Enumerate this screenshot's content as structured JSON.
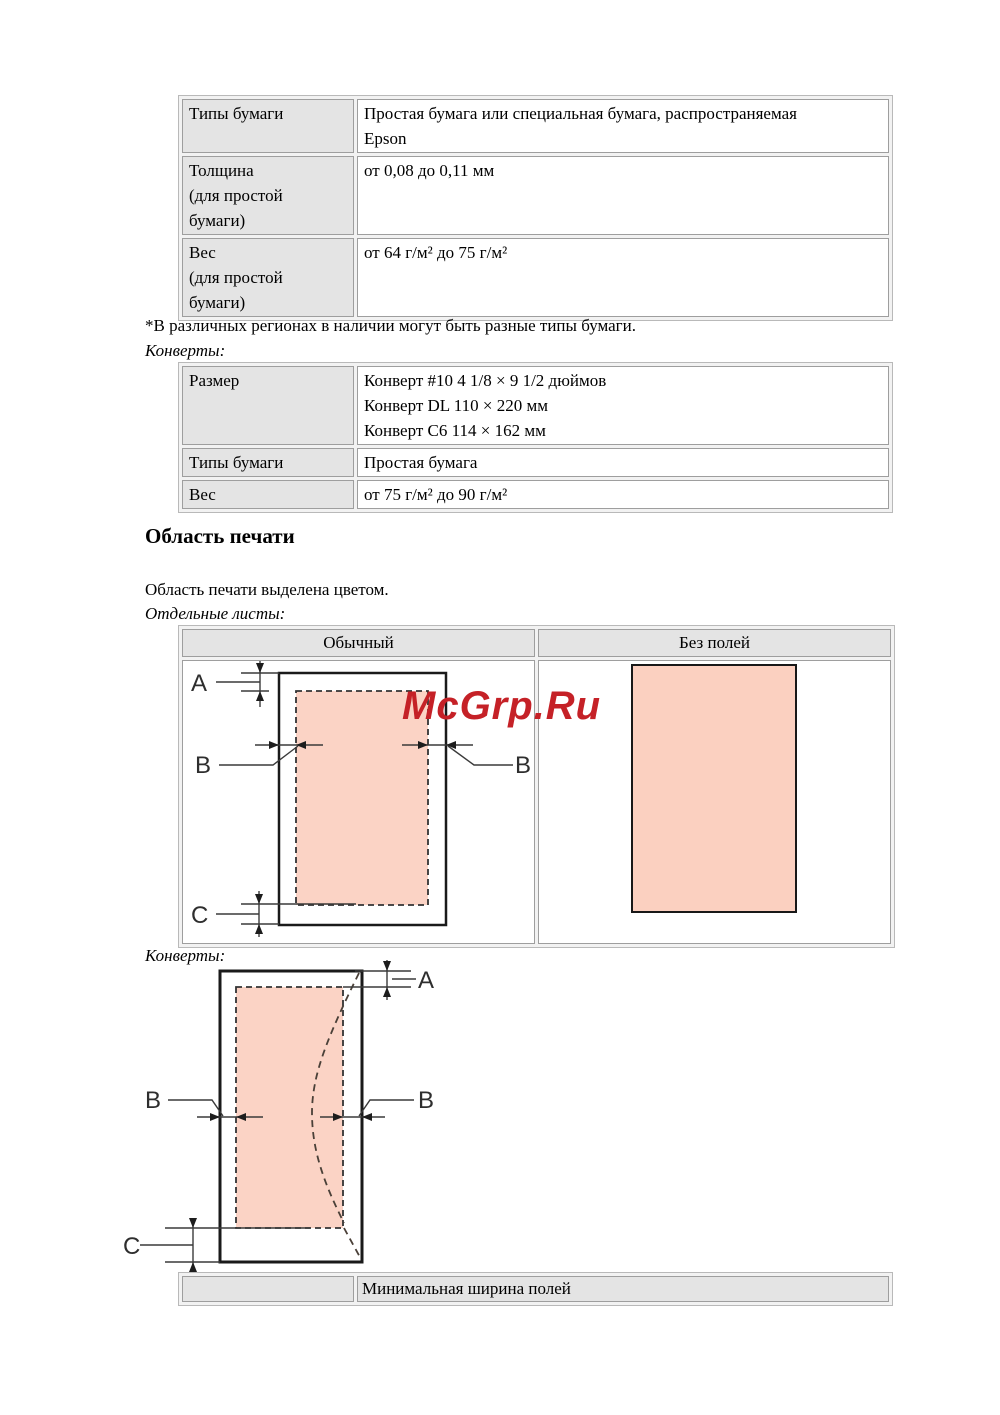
{
  "colors": {
    "print_area_fill": "#fbd3c5",
    "borderless_fill": "#fbd0c0",
    "watermark_red": "#c52127",
    "header_cell_gray": "#e4e4e4",
    "table_border_gray": "#9e9e9e"
  },
  "paper_table": {
    "rows": [
      {
        "label_lines": [
          "Типы бумаги"
        ],
        "value_lines": [
          "Простая бумага или специальная бумага, распространяемая",
          "Epson"
        ]
      },
      {
        "label_lines": [
          "Толщина",
          "(для простой",
          "бумаги)"
        ],
        "value_lines": [
          "от 0,08 до 0,11 мм"
        ]
      },
      {
        "label_lines": [
          "Вес",
          "(для простой",
          "бумаги)"
        ],
        "value_lines": [
          "от 64 г/м² до 75 г/м²"
        ]
      }
    ]
  },
  "footnote": "*В различных регионах в наличии могут быть разные типы бумаги.",
  "envelopes_label_1": "Конверты:",
  "envelope_table": {
    "rows": [
      {
        "label_lines": [
          "Размер"
        ],
        "value_lines": [
          "Конверт #10 4 1/8 × 9 1/2 дюймов",
          "Конверт DL 110 × 220 мм",
          "Конверт C6 114 × 162 мм"
        ]
      },
      {
        "label_lines": [
          "Типы бумаги"
        ],
        "value_lines": [
          "Простая бумага"
        ]
      },
      {
        "label_lines": [
          "Вес"
        ],
        "value_lines": [
          "от 75 г/м² до 90 г/м²"
        ]
      }
    ]
  },
  "section": {
    "heading": "Область печати",
    "intro": "Область печати выделена цветом.",
    "sheets_label": "Отдельные листы:",
    "envelopes_label_2": "Конверты:"
  },
  "print_area_table": {
    "col1_header": "Обычный",
    "col2_header": "Без полей"
  },
  "diagram_labels": {
    "a": "A",
    "b": "B",
    "c": "C"
  },
  "watermark": "McGrp.Ru",
  "bottom_table": {
    "header": "Минимальная ширина полей"
  }
}
